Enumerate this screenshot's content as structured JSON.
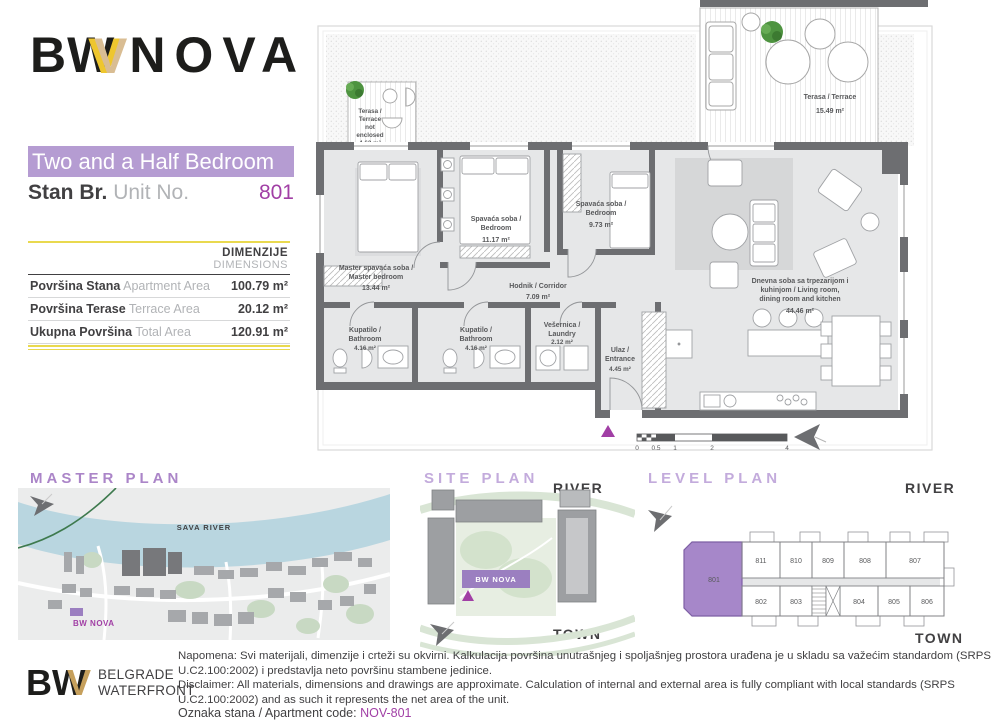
{
  "brand": {
    "bw": "BW",
    "gold_v": "V",
    "nova": "NOVA"
  },
  "header": {
    "type_label": "Two and a Half Bedroom",
    "unit_label_sr": "Stan Br.",
    "unit_label_en": "Unit No.",
    "unit_number": "801"
  },
  "dimensions_table": {
    "header_sr": "DIMENZIJE",
    "header_en": "DIMENSIONS",
    "rows": [
      {
        "label_sr": "Površina Stana",
        "label_en": "Apartment Area",
        "value": "100.79 m²"
      },
      {
        "label_sr": "Površina Terase",
        "label_en": "Terrace Area",
        "value": "20.12 m²"
      },
      {
        "label_sr": "Ukupna Površina",
        "label_en": "Total Area",
        "value": "120.91 m²"
      }
    ]
  },
  "floor_plan": {
    "rooms": {
      "terrace_small": {
        "lines": [
          "Terasa /",
          "Terrace",
          "not",
          "enclosed"
        ],
        "area": "4.63 m²"
      },
      "terrace_large": {
        "label": "Terasa / Terrace",
        "area": "15.49 m²"
      },
      "master": {
        "lines": [
          "Master spavaća soba /",
          "Master bedroom"
        ],
        "area": "13.44 m²"
      },
      "bedroom_mid": {
        "lines": [
          "Spavaća soba /",
          "Bedroom"
        ],
        "area": "11.17 m²"
      },
      "bedroom_small": {
        "lines": [
          "Spavaća soba /",
          "Bedroom"
        ],
        "area": "9.73 m²"
      },
      "corridor": {
        "label": "Hodnik / Corridor",
        "area": "7.09 m²"
      },
      "bathroom_1": {
        "lines": [
          "Kupatilo /",
          "Bathroom"
        ],
        "area": "4.16 m²"
      },
      "bathroom_2": {
        "lines": [
          "Kupatilo /",
          "Bathroom"
        ],
        "area": "4.16 m²"
      },
      "laundry": {
        "lines": [
          "Vešernica /",
          "Laundry"
        ],
        "area": "2.12 m²"
      },
      "entrance": {
        "lines": [
          "Ulaz /",
          "Entrance"
        ],
        "area": "4.45 m²"
      },
      "living": {
        "lines": [
          "Dnevna soba sa trpezarijom i",
          "kuhinjom / Living room,",
          "dining room and kitchen"
        ],
        "area": "44.46 m²"
      }
    },
    "scale": {
      "ticks": [
        "0",
        "0.5",
        "1",
        "2",
        "4"
      ]
    }
  },
  "plans": {
    "master": {
      "title": "MASTER PLAN",
      "river_label": "SAVA RIVER",
      "project_label": "BW NOVA"
    },
    "site": {
      "title": "SITE PLAN",
      "river": "RIVER",
      "town": "TOWN",
      "project_label": "BW NOVA"
    },
    "level": {
      "title": "LEVEL PLAN",
      "river": "RIVER",
      "town": "TOWN",
      "highlighted_unit": "801",
      "top_row": [
        "811",
        "810",
        "809",
        "808",
        "807"
      ],
      "bottom_row": [
        "802",
        "803",
        "804",
        "805",
        "806"
      ]
    }
  },
  "footer": {
    "logo": {
      "bw": "BW",
      "gold_v": "V",
      "line1": "BELGRADE",
      "line2": "WATERFRONT"
    },
    "napomena": "Napomena: Svi materijali, dimenzije i crteži su okvirni. Kalkulacija površina unutrašnjeg i spoljašnjeg prostora urađena je u skladu sa važećim standardom (SRPS U.C2.100:2002) i predstavlja neto površinu stambene jedinice.",
    "disclaimer": "Disclaimer: All materials, dimensions and drawings are approximate. Calculation of internal and external area is fully compliant with local standards (SRPS U.C2.100:2002) and as such it represents the net area of the unit.",
    "code_label": "Oznaka stana / Apartment code:",
    "code_value": "NOV-801"
  },
  "colors": {
    "accent_purple": "#a13fa5",
    "banner_purple": "#b59cd2",
    "unit_fill_purple": "#a687c9",
    "table_rule_yellow": "#e9d94f",
    "wall_gray": "#6d6e71",
    "floor_gray": "#e6e7e8",
    "gold": "#eec62e"
  }
}
